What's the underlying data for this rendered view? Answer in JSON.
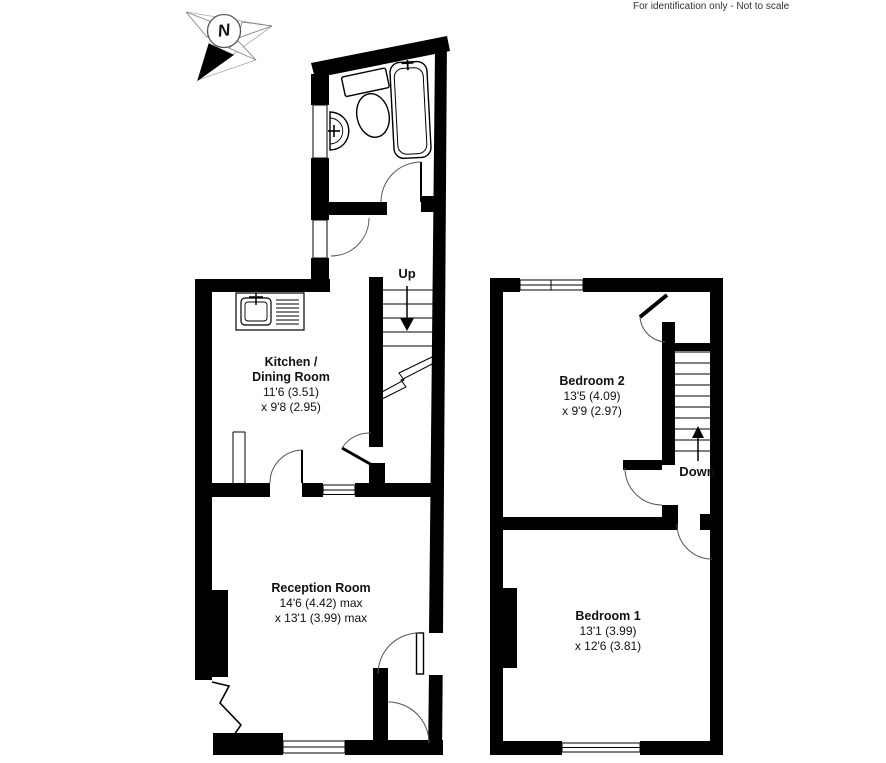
{
  "disclaimer": "For identification only - Not to scale",
  "compass": {
    "label": "N"
  },
  "ground_floor": {
    "kitchen": {
      "name_line1": "Kitchen /",
      "name_line2": "Dining Room",
      "dim1": "11'6 (3.51)",
      "dim2": "x 9'8 (2.95)"
    },
    "reception": {
      "name": "Reception Room",
      "dim1": "14'6 (4.42) max",
      "dim2": "x 13'1 (3.99) max"
    },
    "stairs_label": "Up"
  },
  "first_floor": {
    "bedroom2": {
      "name": "Bedroom 2",
      "dim1": "13'5 (4.09)",
      "dim2": "x 9'9 (2.97)"
    },
    "bedroom1": {
      "name": "Bedroom 1",
      "dim1": "13'1 (3.99)",
      "dim2": "x 12'6 (3.81)"
    },
    "stairs_label": "Down"
  },
  "colors": {
    "wall": "#000000",
    "background": "#ffffff",
    "text": "#111111"
  }
}
